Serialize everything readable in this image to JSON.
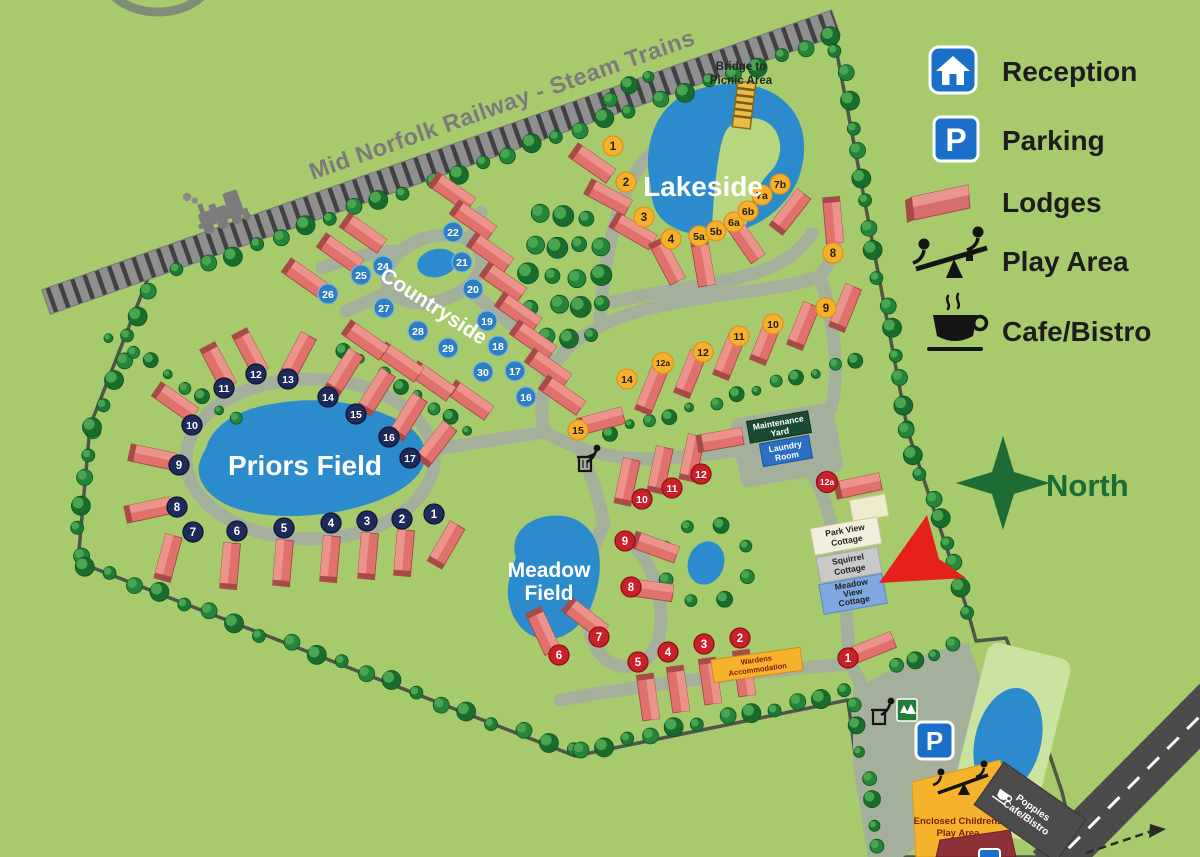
{
  "railway": {
    "label": "Mid Norfolk Railway - Steam Trains"
  },
  "legend": {
    "reception": "Reception",
    "parking": "Parking",
    "lodges": "Lodges",
    "play_area": "Play Area",
    "cafe": "Cafe/Bistro",
    "parking_letter": "P"
  },
  "map_sign": {
    "parking_letter": "P"
  },
  "compass": {
    "label": "North"
  },
  "areas": {
    "lakeside": "Lakeside",
    "countryside": "Countryside",
    "priors_field": "Priors Field",
    "meadow_line1": "Meadow",
    "meadow_line2": "Field"
  },
  "bridge": {
    "line1": "Bridge to",
    "line2": "Picnic Area"
  },
  "signs": {
    "maintenance": {
      "l1": "Maintenance",
      "l2": "Yard"
    },
    "laundry": {
      "l1": "Laundry",
      "l2": "Room"
    },
    "park_view": {
      "l1": "Park View",
      "l2": "Cottage"
    },
    "squirrel": {
      "l1": "Squirrel",
      "l2": "Cottage"
    },
    "meadow_view": {
      "l1": "Meadow",
      "l2": "View",
      "l3": "Cottage"
    },
    "wardens": {
      "l1": "Wardens",
      "l2": "Accommodation"
    },
    "play": {
      "l1": "Enclosed Childrens",
      "l2": "Play Area"
    },
    "poppies": {
      "l1": "Poppies",
      "l2": "Cafe/Bistro"
    }
  },
  "colors": {
    "outer_green": "#a7cb6c",
    "park_green": "#b7d77f",
    "path": "#a5b09c",
    "water": "#2b8bcd",
    "lodge_body": "#e0716d",
    "lodge_roof": "#ec938b",
    "lodge_end": "#a84a48",
    "north": "#1d6b35",
    "arrow": "#e6211c",
    "sign_blue": "#1a70c8"
  },
  "badges": {
    "lakeside": {
      "fill": "#f7b02c",
      "text_color": "#241f15",
      "stroke": "#d9941c",
      "items": [
        {
          "label": "1",
          "x": 613,
          "y": 146
        },
        {
          "label": "2",
          "x": 626,
          "y": 182
        },
        {
          "label": "3",
          "x": 644,
          "y": 217
        },
        {
          "label": "4",
          "x": 671,
          "y": 239
        },
        {
          "label": "5a",
          "x": 699,
          "y": 236
        },
        {
          "label": "5b",
          "x": 716,
          "y": 231
        },
        {
          "label": "6a",
          "x": 734,
          "y": 222
        },
        {
          "label": "6b",
          "x": 748,
          "y": 211
        },
        {
          "label": "7a",
          "x": 762,
          "y": 195
        },
        {
          "label": "7b",
          "x": 780,
          "y": 184
        },
        {
          "label": "8",
          "x": 833,
          "y": 253
        },
        {
          "label": "9",
          "x": 826,
          "y": 308
        },
        {
          "label": "10",
          "x": 773,
          "y": 324
        },
        {
          "label": "11",
          "x": 739,
          "y": 336
        },
        {
          "label": "12",
          "x": 703,
          "y": 352
        },
        {
          "label": "12a",
          "x": 663,
          "y": 363
        },
        {
          "label": "14",
          "x": 627,
          "y": 379
        },
        {
          "label": "15",
          "x": 578,
          "y": 430
        }
      ]
    },
    "countryside": {
      "fill": "#2e7fc1",
      "text_color": "#ffffff",
      "stroke": "#7fb2dc",
      "items": [
        {
          "label": "16",
          "x": 526,
          "y": 397
        },
        {
          "label": "17",
          "x": 515,
          "y": 371
        },
        {
          "label": "18",
          "x": 498,
          "y": 346
        },
        {
          "label": "19",
          "x": 487,
          "y": 321
        },
        {
          "label": "20",
          "x": 473,
          "y": 289
        },
        {
          "label": "21",
          "x": 462,
          "y": 262
        },
        {
          "label": "22",
          "x": 453,
          "y": 232
        },
        {
          "label": "24",
          "x": 383,
          "y": 266
        },
        {
          "label": "25",
          "x": 361,
          "y": 275
        },
        {
          "label": "26",
          "x": 328,
          "y": 294
        },
        {
          "label": "27",
          "x": 384,
          "y": 308
        },
        {
          "label": "28",
          "x": 418,
          "y": 331
        },
        {
          "label": "29",
          "x": 448,
          "y": 348
        },
        {
          "label": "30",
          "x": 483,
          "y": 372
        }
      ]
    },
    "priors_field": {
      "fill": "#1e2a5a",
      "text_color": "#ffffff",
      "stroke": "#0e1637",
      "items": [
        {
          "label": "1",
          "x": 434,
          "y": 514
        },
        {
          "label": "2",
          "x": 402,
          "y": 519
        },
        {
          "label": "3",
          "x": 367,
          "y": 521
        },
        {
          "label": "4",
          "x": 331,
          "y": 523
        },
        {
          "label": "5",
          "x": 284,
          "y": 528
        },
        {
          "label": "6",
          "x": 237,
          "y": 531
        },
        {
          "label": "7",
          "x": 193,
          "y": 532
        },
        {
          "label": "8",
          "x": 177,
          "y": 507
        },
        {
          "label": "9",
          "x": 179,
          "y": 465
        },
        {
          "label": "10",
          "x": 192,
          "y": 425
        },
        {
          "label": "11",
          "x": 224,
          "y": 388
        },
        {
          "label": "12",
          "x": 256,
          "y": 374
        },
        {
          "label": "13",
          "x": 288,
          "y": 379
        },
        {
          "label": "14",
          "x": 328,
          "y": 397
        },
        {
          "label": "15",
          "x": 356,
          "y": 414
        },
        {
          "label": "16",
          "x": 389,
          "y": 437
        },
        {
          "label": "17",
          "x": 410,
          "y": 458
        }
      ]
    },
    "meadow_field": {
      "fill": "#c9202a",
      "text_color": "#ffffff",
      "stroke": "#8e1118",
      "items": [
        {
          "label": "1",
          "x": 848,
          "y": 658
        },
        {
          "label": "2",
          "x": 740,
          "y": 638
        },
        {
          "label": "3",
          "x": 704,
          "y": 644
        },
        {
          "label": "4",
          "x": 668,
          "y": 652
        },
        {
          "label": "5",
          "x": 638,
          "y": 662
        },
        {
          "label": "6",
          "x": 559,
          "y": 655
        },
        {
          "label": "7",
          "x": 599,
          "y": 637
        },
        {
          "label": "8",
          "x": 631,
          "y": 587
        },
        {
          "label": "9",
          "x": 625,
          "y": 541
        },
        {
          "label": "10",
          "x": 642,
          "y": 499
        },
        {
          "label": "11",
          "x": 672,
          "y": 488
        },
        {
          "label": "12",
          "x": 701,
          "y": 474
        },
        {
          "label": "12a",
          "x": 827,
          "y": 482
        }
      ]
    }
  }
}
